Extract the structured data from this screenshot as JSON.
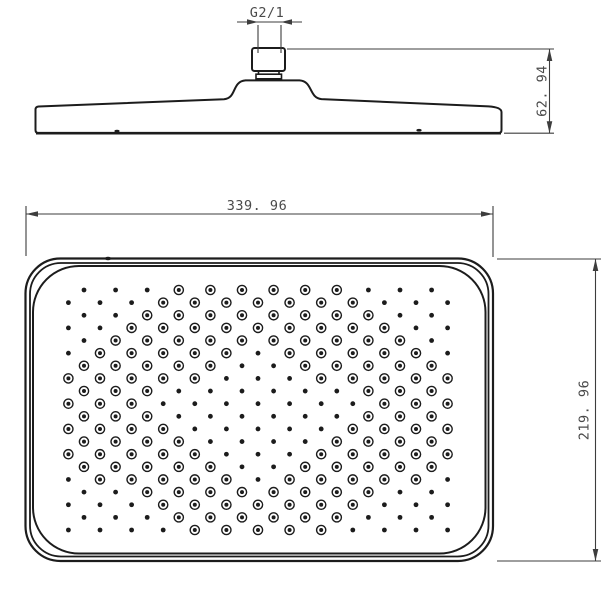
{
  "drawing": {
    "product": "square-shower-head",
    "dimensions": {
      "thread": {
        "label": "G2/1"
      },
      "height": {
        "label": "62. 94"
      },
      "width": {
        "label": "339. 96"
      },
      "depth": {
        "label": "219. 96"
      }
    },
    "colors": {
      "outline": "#1c1c1c",
      "dimension": "#3d3d3d",
      "text": "#4a4a4a",
      "background": "#ffffff"
    },
    "spray_pattern": {
      "rows": 20,
      "row_spacing": 12.632,
      "col_spacing": 31.6,
      "start_y": 290,
      "even_row_start_x": 84,
      "even_row_count": 12,
      "odd_row_start_x": 68.4,
      "odd_row_count": 13,
      "center_x": 258,
      "center_y": 410,
      "half_width": 190,
      "half_height": 120,
      "ring_band_min": 0.58,
      "ring_band_max": 1.42,
      "dot_radius": 2.4,
      "ring_outer_radius": 4.6,
      "ring_inner_radius": 2.0,
      "ring_stroke_width": 1.4
    }
  }
}
